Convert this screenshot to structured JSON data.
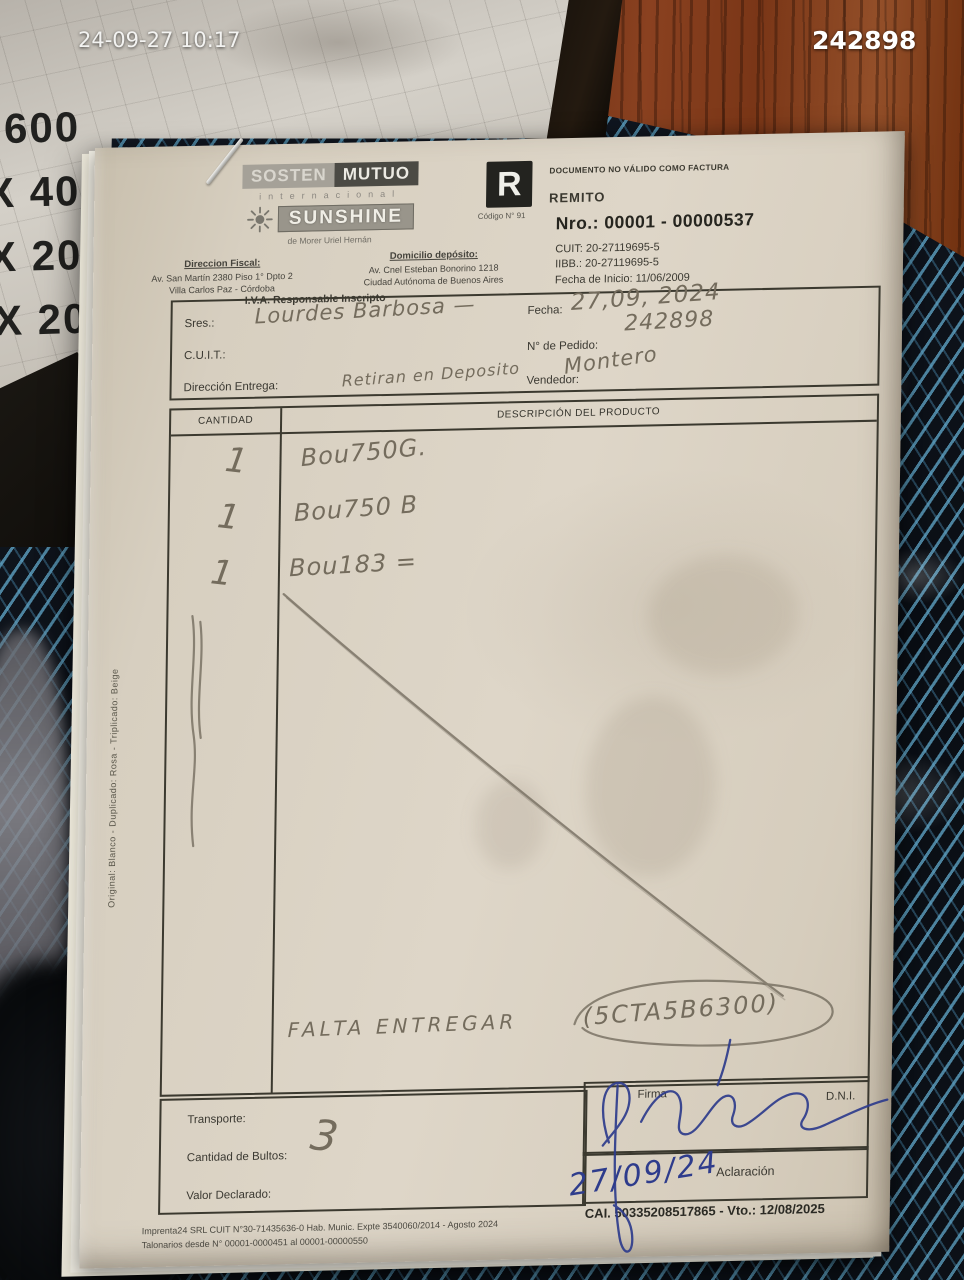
{
  "photo_overlay": {
    "timestamp": "24-09-27 10:17",
    "number": "242898"
  },
  "background": {
    "cardboard_lines": [
      "600",
      "X 400",
      "X 200",
      "X 20"
    ]
  },
  "brand": {
    "name_part1": "SOSTEN",
    "name_part2": "MUTUO",
    "subtitle": "internacional",
    "product": "SUNSHINE",
    "owner": "de Morer Uriel Hernán",
    "fiscal_label": "Direccion Fiscal:",
    "fiscal_address1": "Av. San Martín 2380 Piso 1° Dpto 2",
    "fiscal_address2": "Villa Carlos Paz - Córdoba",
    "deposit_label": "Domicilio depósito:",
    "deposit_address1": "Av. Cnel Esteban Bonorino 1218",
    "deposit_address2": "Ciudad Autónoma de Buenos Aires",
    "iva_status": "I.V.A. Responsable Inscripto"
  },
  "doc": {
    "letter": "R",
    "code": "Código N° 91",
    "disclaimer": "DOCUMENTO NO VÁLIDO COMO FACTURA",
    "doc_type": "REMITO",
    "number": "Nro.: 00001 - 00000537",
    "cuit": "CUIT:  20-27119695-5",
    "iibb": "IIBB.:  20-27119695-5",
    "start_date": "Fecha de Inicio: 11/06/2009"
  },
  "fields": {
    "sres_label": "Sres.:",
    "sres_value": "Lourdes Barbosa —",
    "cuit_label": "C.U.I.T.:",
    "cuit_value": "",
    "delivery_label": "Dirección Entrega:",
    "delivery_value": "Retiran en Deposito",
    "date_label": "Fecha:",
    "date_value": "27,09, 2024",
    "date_note": "242898",
    "order_label": "N° de Pedido:",
    "order_value": "",
    "seller_label": "Vendedor:",
    "seller_value": "Montero"
  },
  "table": {
    "qty_header": "CANTIDAD",
    "desc_header": "DESCRIPCIÓN DEL PRODUCTO",
    "rows": [
      {
        "qty": "1",
        "desc": "Bou750G."
      },
      {
        "qty": "1",
        "desc": "Bou750 B"
      },
      {
        "qty": "1",
        "desc": "Bou183 ="
      }
    ],
    "handwritten_note": "FALTA ENTREGAR",
    "handwritten_note2": "(5CTA5B6300)"
  },
  "bottom": {
    "transport_label": "Transporte:",
    "transport_value": "",
    "packages_label": "Cantidad de Bultos:",
    "packages_value": "3",
    "declared_value_label": "Valor Declarado:",
    "declared_value": "",
    "signature_label": "Firma",
    "dni_label": "D.N.I.",
    "clarification_label": "Aclaración",
    "clarification_value": "27/09/24"
  },
  "footer": {
    "print_line1": "Imprenta24 SRL CUIT N°30-71435636-0 Hab. Munic. Expte 3540060/2014 - Agosto 2024",
    "print_line2": "Talonarios desde N° 00001-0000451 al 00001-00000550",
    "cai": "CAI. 50335208517865  -  Vto.: 12/08/2025"
  },
  "side_note": "Original: Blanco - Duplicado: Rosa - Triplicado: Beige",
  "colors": {
    "pencil": "#746c5d",
    "pen": "#2e3c8c",
    "paper": "#d8d0c2"
  }
}
